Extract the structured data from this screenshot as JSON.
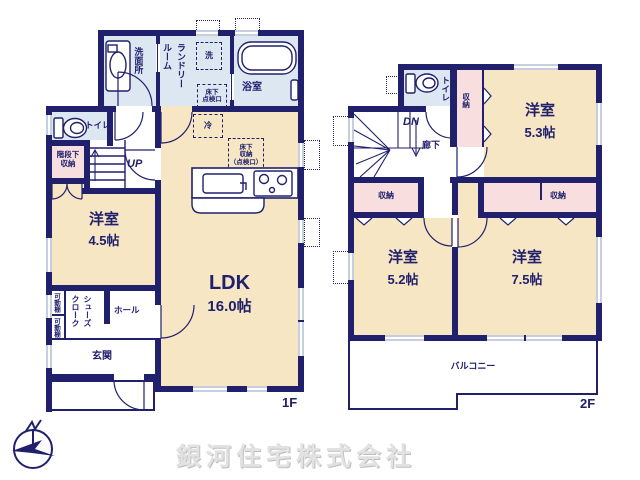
{
  "colors": {
    "wall": "#20206d",
    "room_cream": "#f6e6c3",
    "wet_blue": "#dde7f2",
    "storage_pink": "#f8dede",
    "window_gray": "#c7cede",
    "company_gray": "#e2e2e2"
  },
  "floor1": {
    "floor_label": "1F",
    "washroom": "洗面所",
    "laundry": {
      "col1": "ランドリー",
      "col2": "ルーム"
    },
    "bathroom": "浴室",
    "washer_box": "洗",
    "hatch_box": {
      "l1": "床下",
      "l2": "点検口"
    },
    "toilet": "トイレ",
    "under_stair_storage": {
      "l1": "階段下",
      "l2": "収納"
    },
    "stairs_up": "UP",
    "fridge_box": "冷",
    "floor_storage_box": {
      "l1": "床下",
      "l2": "収納",
      "l3": "（点検口）"
    },
    "western_room": {
      "name": "洋室",
      "size": "4.5帖"
    },
    "ldk": {
      "name": "LDK",
      "size": "16.0帖"
    },
    "movable_shelf_1": "可動棚",
    "movable_shelf_2": "可動棚",
    "shoe_closet": {
      "col1": "シューズ",
      "col2": "クローク"
    },
    "hall": "ホール",
    "entrance": "玄関"
  },
  "floor2": {
    "floor_label": "2F",
    "toilet": "トイレ",
    "stairs_down": "DN",
    "hallway": "廊下",
    "closet_53": "収納",
    "room_53": {
      "name": "洋室",
      "size": "5.3帖"
    },
    "closet_52": "収納",
    "closet_75": "収納",
    "room_52": {
      "name": "洋室",
      "size": "5.2帖"
    },
    "room_75": {
      "name": "洋室",
      "size": "7.5帖"
    },
    "balcony": "バルコニー"
  },
  "footer": {
    "company": "銀河住宅株式会社",
    "compass": "N"
  }
}
